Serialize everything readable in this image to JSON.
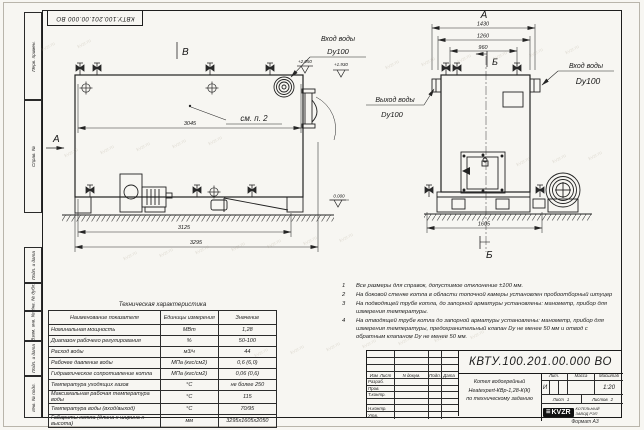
{
  "sheet": {
    "doc_number": "КВТУ.100.201.00.000 ВО",
    "format_label": "Формат А3"
  },
  "left_strip": {
    "items": [
      "Перв. примен.",
      "Справ. №",
      "Подп. и дата",
      "Инв. № дубл.",
      "Взам. инв. №",
      "Подп. и дата",
      "Инв. № подл."
    ]
  },
  "drawing": {
    "view_a_arrow": "А",
    "view_b_arrow": "В",
    "view_a_title": "А",
    "section_b_top": "Б",
    "section_b_bottom": "Б",
    "see_note_label": "см. п. 2",
    "elev_plus_2050": "+2.050",
    "elev_plus_1930": "+1.930",
    "elev_zero": "0.000",
    "dims": {
      "body_length": "3045",
      "frame_length": "3125",
      "overall_length": "3295",
      "overall_width": "1430",
      "width_1260": "1260",
      "valve_span": "960",
      "base_width": "1605"
    },
    "labels": {
      "inlet_top": "Вход воды",
      "inlet_top_dn": "Dy100",
      "outlet": "Выход воды",
      "outlet_dn": "Dy100",
      "inlet_right": "Вход воды",
      "inlet_right_dn": "Dy100"
    }
  },
  "notes": {
    "items": [
      {
        "num": "1",
        "text": "Все размеры для справок, допустимое отклонение ±100 мм."
      },
      {
        "num": "2",
        "text": "На боковой стенке котла в области топочной камеры установлен пробоотборный штуцер"
      },
      {
        "num": "3",
        "text": "На подводящей трубе котла, до запорной арматуры установлены: манометр, прибор для измерения температуры."
      },
      {
        "num": "4",
        "text": "На отводящей трубе котла до запорной арматуры установлены: манометр, прибор для измерения температуры, предохранительный клапан Dу не менее 50 мм и отвод с обратным клапаном Dу не менее 50 мм."
      }
    ]
  },
  "tech_table": {
    "title": "Техническая характеристика",
    "headers": [
      "Наименование показателя",
      "Единицы измерения",
      "Значение"
    ],
    "rows": [
      [
        "Номинальная мощность",
        "МВт",
        "1,28"
      ],
      [
        "Диапазон рабочего регулирования",
        "%",
        "50-100"
      ],
      [
        "Расход воды",
        "м3/ч",
        "44"
      ],
      [
        "Рабочее давление воды",
        "МПа (кгс/см2)",
        "0,6 (6,0)"
      ],
      [
        "Гидравлическое сопротивление котла",
        "МПа (кгс/см2)",
        "0,06 (0,6)"
      ],
      [
        "Температура уходящих газов",
        "°С",
        "не более 250"
      ],
      [
        "Максимальная рабочая температура воды",
        "°С",
        "115"
      ],
      [
        "Температура воды (вход/выход)",
        "°С",
        "70/95"
      ],
      [
        "Габариты котла (длина х ширина х высота)",
        "мм",
        "3295х1605х2050"
      ]
    ]
  },
  "title_block": {
    "doc_number": "КВТУ.100.201.00.000 ВО",
    "sign_header": [
      "Изм",
      "Лист",
      "N докум.",
      "Подп.",
      "Дата"
    ],
    "sign_rows": [
      "Разраб.",
      "Пров.",
      "Т.контр.",
      "",
      "Н.контр.",
      "Утв."
    ],
    "name_lines": [
      "Котел водогрейный",
      "Heatexpert-КВр-1,28-К(К)",
      "по техническому заданию"
    ],
    "lit_label": "Лит.",
    "mass_label": "Масса",
    "scale_label": "Масштаб",
    "lit_value": "И",
    "scale_value": "1:20",
    "sheet_label": "Лист",
    "sheet_value": "1",
    "sheets_label": "Листов",
    "sheets_value": "2",
    "logo_text": "KVZR",
    "logo_caption": [
      "КОТЕЛЬНЫЙ",
      "ЗАВОД РЭП"
    ]
  },
  "watermark": {
    "text": "kvzr.ru"
  }
}
